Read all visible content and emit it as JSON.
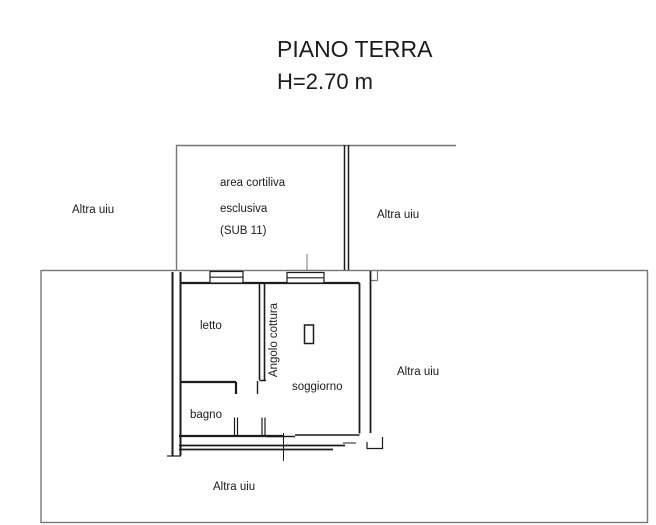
{
  "page": {
    "title": "PIANO TERRA",
    "subtitle": "H=2.70 m"
  },
  "plan": {
    "courtyard": {
      "line1": "area cortiliva",
      "line2": "esclusiva",
      "line3": "(SUB 11)"
    },
    "rooms": {
      "letto": "letto",
      "angolo_cottura": "Angolo cottura",
      "soggiorno": "soggiorno",
      "bagno": "bagno"
    },
    "neighbors": {
      "left": "Altra uiu",
      "right_top": "Altra uiu",
      "right_mid": "Altra uiu",
      "bottom": "Altra uiu"
    }
  },
  "colors": {
    "background": "#ffffff",
    "wall": "#1c1c1c",
    "boundary": "#767676",
    "text": "#1b1b1b"
  }
}
